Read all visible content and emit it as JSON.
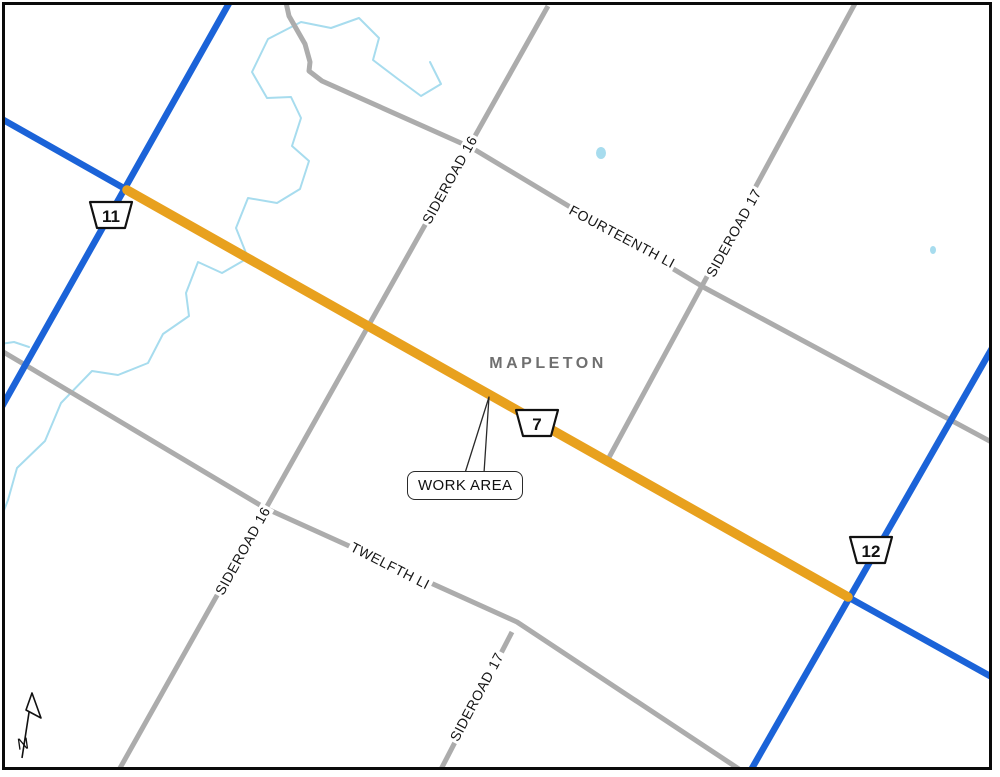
{
  "map": {
    "region": "MAPLETON",
    "work_area_label": "WORK AREA",
    "north_indicator": "N",
    "highway_shields": [
      {
        "number": "11"
      },
      {
        "number": "7"
      },
      {
        "number": "12"
      }
    ],
    "road_labels": {
      "sideroad_16_upper": "SIDEROAD 16",
      "sideroad_16_lower": "SIDEROAD 16",
      "sideroad_17_upper": "SIDEROAD 17",
      "sideroad_17_lower": "SIDEROAD 17",
      "fourteenth_line": "FOURTEENTH LI",
      "twelfth_line": "TWELFTH LI"
    },
    "colors": {
      "highway_blue": "#1B63D8",
      "work_area_orange": "#E8A11E",
      "local_road_gray": "#ACACAC",
      "river_blue": "#A7DCEE",
      "region_text_gray": "#6F6F6F"
    }
  }
}
